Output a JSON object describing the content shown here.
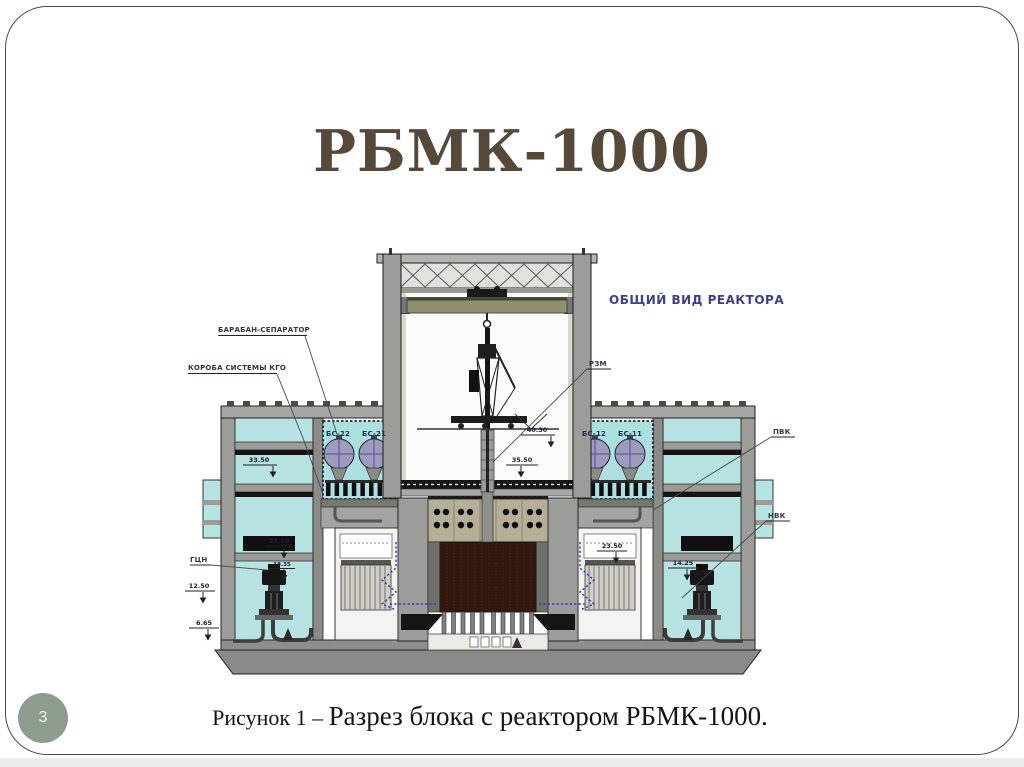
{
  "slide": {
    "title": "РБМК-1000",
    "page_number": "3",
    "caption_prefix": "Рисунок 1 – ",
    "caption_main": "Разрез блока с реактором РБМК-1000."
  },
  "diagram": {
    "heading": "ОБЩИЙ ВИД РЕАКТОРА",
    "callouts": {
      "drum_separator": "БАРАБАН-СЕПАРАТОР",
      "kgo_ducts": "КОРОБА СИСТЕМЫ КГО",
      "refueling_machine": "РЗМ",
      "steam_water_lines": "ПВК",
      "lower_water_lines": "НВК",
      "main_pump": "ГЦН",
      "bs_22": "БС-22",
      "bs_21": "БС-21",
      "bs_12": "БС-12",
      "bs_11": "БС-11"
    },
    "elevations": {
      "left_outer": "33.50",
      "hall_upper": "40.30",
      "hall_floor": "35.50",
      "left_mid_upper": "23.50",
      "left_mid_lower": "18.35",
      "left_low": "12.50",
      "left_bottom": "6.65",
      "right_mid": "23.50",
      "right_low": "14.25"
    }
  },
  "colors": {
    "title-color": "#57493a",
    "heading-color": "#3b3f8e",
    "badge-color": "#8e9c90",
    "water-color": "#b7e3e2",
    "core-color": "#2f180c"
  }
}
